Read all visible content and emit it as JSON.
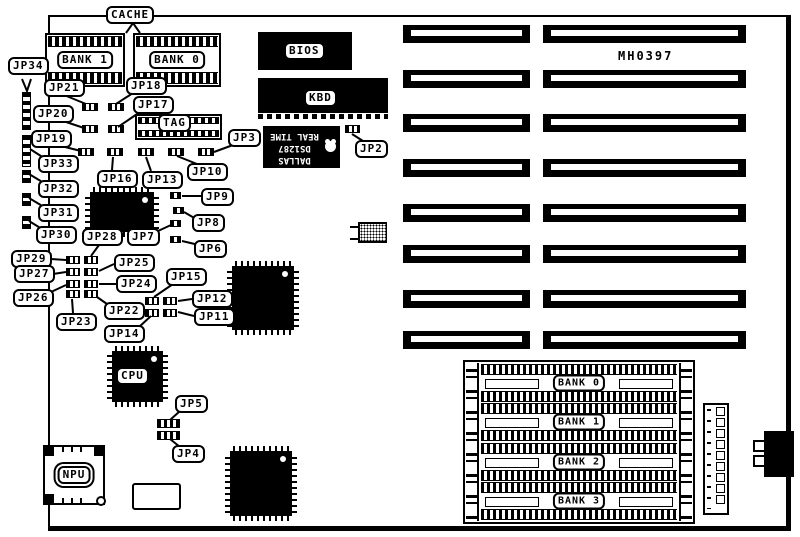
{
  "board_code": "MH0397",
  "labels": {
    "cache": "CACHE",
    "bank1": "BANK 1",
    "bank0": "BANK 0",
    "tag": "TAG",
    "bios": "BIOS",
    "kbd": "KBD",
    "cpu": "CPU",
    "npu": "NPU",
    "mh0397": "MH0397",
    "jp2": "JP2",
    "jp3": "JP3",
    "jp4": "JP4",
    "jp5": "JP5",
    "jp6": "JP6",
    "jp7": "JP7",
    "jp8": "JP8",
    "jp9": "JP9",
    "jp10": "JP10",
    "jp11": "JP11",
    "jp12": "JP12",
    "jp13": "JP13",
    "jp14": "JP14",
    "jp15": "JP15",
    "jp16": "JP16",
    "jp17": "JP17",
    "jp18": "JP18",
    "jp19": "JP19",
    "jp20": "JP20",
    "jp21": "JP21",
    "jp22": "JP22",
    "jp23": "JP23",
    "jp24": "JP24",
    "jp25": "JP25",
    "jp26": "JP26",
    "jp27": "JP27",
    "jp28": "JP28",
    "jp29": "JP29",
    "jp30": "JP30",
    "jp31": "JP31",
    "jp32": "JP32",
    "jp33": "JP33",
    "jp34": "JP34",
    "simm0": "BANK 0",
    "simm1": "BANK 1",
    "simm2": "BANK 2",
    "simm3": "BANK 3"
  },
  "rtc": {
    "brand": "DALLAS",
    "part": "DS1287",
    "type": "REAL TIME"
  },
  "slot_count": {
    "left_column": 8,
    "right_column": 8
  },
  "colors": {
    "ink": "#000000",
    "paper": "#ffffff"
  }
}
